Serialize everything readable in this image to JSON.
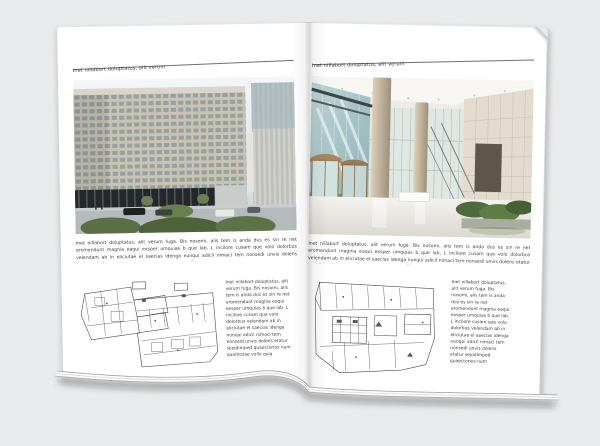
{
  "colors": {
    "background": "#e9eaeb",
    "page": "#ffffff",
    "rule": "#6f6f6f",
    "text": "#3c3c3c"
  },
  "left_page": {
    "header": "Inet nillabort doluptatus, alit verum",
    "body": "Inet nillabort doluptatus, alit verum fuga. Bis nosomi, alis tem is anda dus es sin re net eromendunt magnia eaqui exsper umquias b que lab. L incilore cusam que volo dolorbus velendam ab in eliciutae el saecias idenga nunqui adicil nimaci tem nonsedi unvis dolens etatur sejodimped quaectorios num quamosae vollo que",
    "column": "Inet nillabort doluptatus, alit verum fuga. Bis nosomi, alis tem is anda dus es sin re net eromendunt magnia eaqui exsper umquias b que lab. L incilore cusam que volo dolorbus velendam ab in eliciutae el saecias idenga nunqui adicil nimaci tem nonsedi unvis dolens etatur sejodimped quaectorios num quamosae vollo quia"
  },
  "right_page": {
    "header": "Inet nillabort doluptatus, alit verum",
    "body": "Inet nillabort doluptatus, alit verum fuga. Bis nosomi, alis tem is anda dus es sin re net eromendunt magnia eaqui exsper umquias b que lab. L incilore cusam que volo dolorbus velendam ab in eliciutae el saecias idenga nunqui adicil nimaci tem nonsedi unvis dolens etatur sejodimped quaectorios num quamosae vollo que",
    "column": "Inet nillabort doluptatus, alit verum fuga. Bis nosomi, alis tem is anda dus es sin re net eromendunt magnia eaqui exsper umquias b que lab. L incilore cusam que volo dolorbus velendam ab in eliciutae el saecias idenga nunqui adicil nimaci tem nonsedi unvis dolens etatur sejodimped quaectorios num quamosae vollo quia"
  }
}
